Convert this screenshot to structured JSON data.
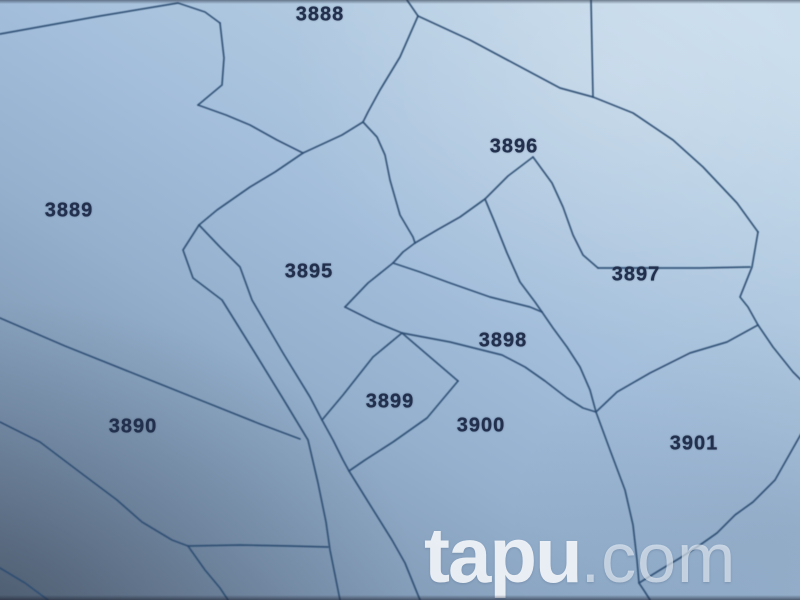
{
  "map": {
    "stroke_color": "#2b4c72",
    "label_color": "#22304e",
    "background_tint": "#a3bedb",
    "parcels": [
      {
        "number": "3888",
        "x": 320,
        "y": 15
      },
      {
        "number": "3889",
        "x": 69,
        "y": 211
      },
      {
        "number": "3890",
        "x": 133,
        "y": 427
      },
      {
        "number": "3895",
        "x": 309,
        "y": 272
      },
      {
        "number": "3896",
        "x": 514,
        "y": 147
      },
      {
        "number": "3897",
        "x": 636,
        "y": 275
      },
      {
        "number": "3898",
        "x": 503,
        "y": 341
      },
      {
        "number": "3899",
        "x": 390,
        "y": 402
      },
      {
        "number": "3900",
        "x": 481,
        "y": 426
      },
      {
        "number": "3901",
        "x": 694,
        "y": 444
      }
    ],
    "lines": [
      {
        "name": "north-boundary-3889",
        "points": "0,34 100,16 178,3 205,12 220,23"
      },
      {
        "name": "parcel3888-west-edge",
        "points": "220,23 224,58 222,85 198,105"
      },
      {
        "name": "parcel3888-south-zigzag",
        "points": "198,105 226,115 250,125 277,140 303,153"
      },
      {
        "name": "junction-to-m-link",
        "points": "303,153 342,135 363,122"
      },
      {
        "name": "parcel3888-east-edge",
        "points": "418,16 400,57 380,90 368,112 363,122"
      },
      {
        "name": "parcel3888-top-vertex",
        "points": "407,0 418,16"
      },
      {
        "name": "ridge-to-junction",
        "points": "418,16 470,40 530,72 560,88 593,97"
      },
      {
        "name": "north-vertical",
        "points": "591,0 593,97"
      },
      {
        "name": "northeast-diagonal",
        "points": "593,97 633,113 673,140 703,167 737,203 758,232"
      },
      {
        "name": "east-chain",
        "points": "758,232 752,267 740,297 748,307 758,325"
      },
      {
        "name": "east-exit",
        "points": "758,325 773,347 793,372 801,380"
      },
      {
        "name": "parcel3901-northwest",
        "points": "758,325 727,342 690,353 650,373 617,392 597,411"
      },
      {
        "name": "parcel3897-south",
        "points": "598,268 650,268 700,268 750,267"
      },
      {
        "name": "parcel3896-southeast",
        "points": "533,157 552,183 563,207 573,235 583,255 598,268"
      },
      {
        "name": "parcel3896-southwest",
        "points": "533,157 508,176 485,199 460,217 437,230 415,243"
      },
      {
        "name": "steep-branch",
        "points": "485,199 495,223 507,253 520,282 535,302 542,312"
      },
      {
        "name": "v2-wedge-link",
        "points": "415,243 403,252 393,263"
      },
      {
        "name": "parcel3895-east",
        "points": "363,122 377,137 385,155 390,180 400,215 413,237 415,243"
      },
      {
        "name": "wedge-top-edge",
        "points": "393,263 420,272 450,283 490,297 530,307 542,312"
      },
      {
        "name": "wedge-west-edge",
        "points": "393,263 368,283 345,307"
      },
      {
        "name": "wedge-bottom-west",
        "points": "345,307 375,322 402,333"
      },
      {
        "name": "wedge-bottom-east",
        "points": "402,333 450,342 502,355 525,367 545,381 567,398 583,408 596,412"
      },
      {
        "name": "wedge-east-edge",
        "points": "542,312 553,328 567,347 580,367 590,390 596,412"
      },
      {
        "name": "parcel3900-east",
        "points": "596,412 610,450 625,490 633,525 637,560 639,583 645,592 650,600"
      },
      {
        "name": "parcel3901-south",
        "points": "639,583 660,570 680,558 700,545 717,533 735,515 753,502 775,480 801,434"
      },
      {
        "name": "parcel3899-northeast",
        "points": "402,333 430,357 458,381"
      },
      {
        "name": "parcel3899-southeast",
        "points": "458,381 427,418 393,442 365,460 349,471"
      },
      {
        "name": "parcel3899-northwest",
        "points": "402,333 373,357 343,395 322,420"
      },
      {
        "name": "road-fork-diagonal",
        "points": "303,153 275,172 250,187 217,210 199,225"
      },
      {
        "name": "road-left-line",
        "points": "199,225 183,250 193,278 222,300 255,353 282,397 308,440 318,483 326,522 330,550 340,600"
      },
      {
        "name": "road-right-line",
        "points": "199,225 220,247 240,267 252,300 283,353 310,397 322,420 333,440 343,460 349,471 367,500 392,540 405,563 420,600"
      },
      {
        "name": "parcel3890-north",
        "points": "0,318 65,346 130,372 200,400 260,424 300,439"
      },
      {
        "name": "parcel3890-southwest",
        "points": "0,422 40,442 77,470 117,500 142,522 172,540 188,546"
      },
      {
        "name": "valley-horizontal",
        "points": "188,546 240,545 290,546 328,547"
      },
      {
        "name": "valley-south-line",
        "points": "188,546 205,570 220,588 228,600"
      },
      {
        "name": "bottom-left-corner-line",
        "points": "0,568 25,583 48,600"
      }
    ]
  },
  "watermark": {
    "bold": "tapu",
    "rest": ".com"
  }
}
